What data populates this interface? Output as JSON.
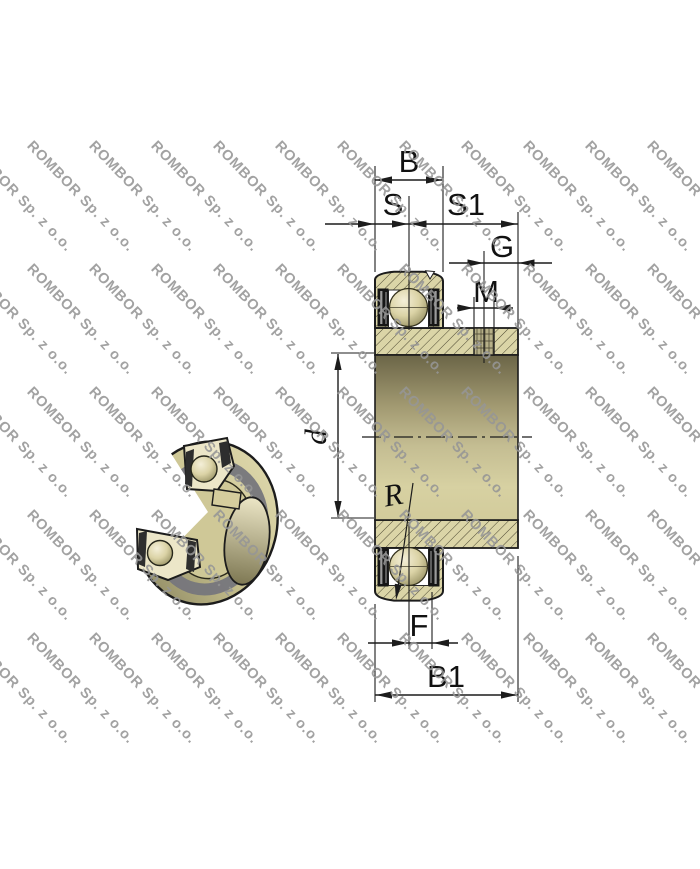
{
  "watermark": {
    "text": "ROMBOR Sp. z o.o."
  },
  "drawing": {
    "type": "bearing-insert-cross-section",
    "labels": {
      "B": "B",
      "S": "S",
      "S1": "S1",
      "G": "G",
      "M": "M",
      "d": "d",
      "R": "R",
      "F": "F",
      "B1": "B1"
    }
  },
  "colors": {
    "line": "#1c1c1c",
    "ring_khaki": "#dbd5a7",
    "body_dark_olive": "#6b6547",
    "body_light_khaki": "#d7d1a2",
    "ball_highlight": "#f4efd8",
    "seal_black": "#161616",
    "seal_gray": "#9a9a9a",
    "watermark_gray": "#969696",
    "background": "#ffffff"
  }
}
